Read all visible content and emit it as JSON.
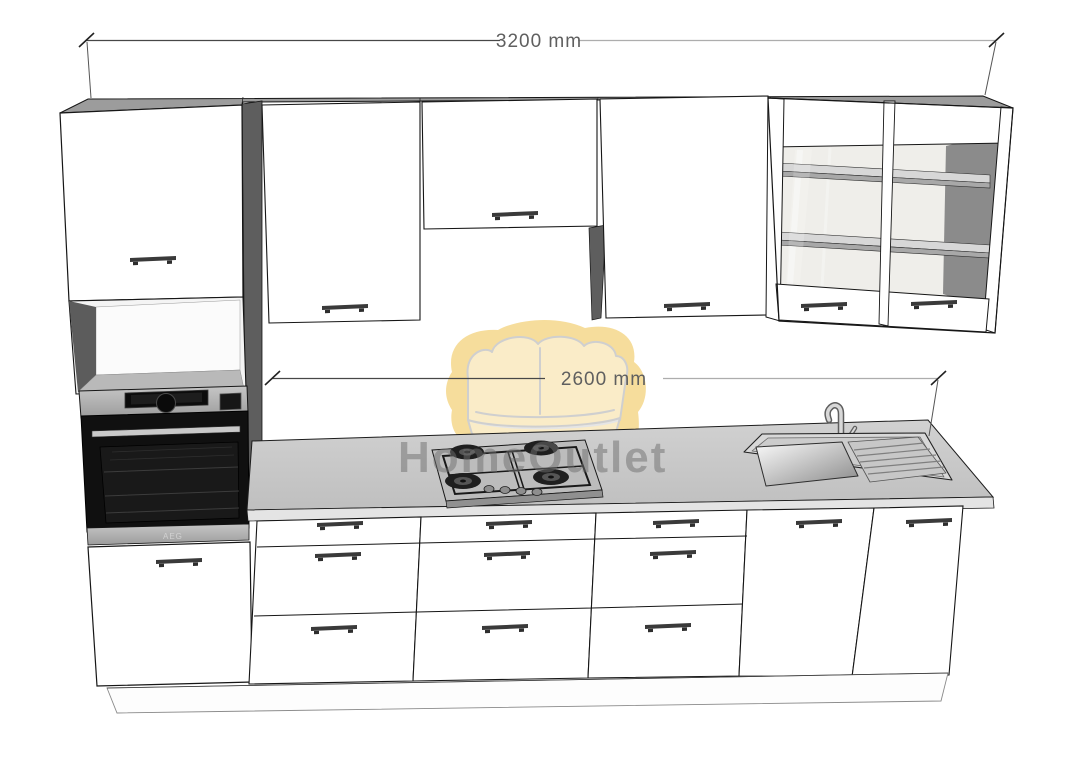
{
  "page": {
    "background": "#ffffff"
  },
  "annotations": {
    "total_width_label": "3200 mm",
    "worktop_width_label": "2600 mm"
  },
  "watermark": {
    "brand_text": "HomeOutlet",
    "icon": "sofa-icon",
    "icon_color": "#f6db97",
    "text_color": "#6f6f6f"
  },
  "appliances": {
    "oven_brand": "AEG"
  },
  "scene": {
    "wall_units": [
      "tall-unit-upper-door",
      "wall-cabinet",
      "short-wall-cabinet-over-hob",
      "wall-cabinet",
      "glass-display-cabinet-two-door"
    ],
    "base_units": [
      "tall-oven-housing",
      "three-drawer-base-unit",
      "three-drawer-base-unit",
      "three-drawer-base-unit",
      "sink-base-two-door"
    ],
    "appliances": [
      "built-in-oven",
      "gas-hob-four-burner",
      "inset-sink-with-drainer",
      "mixer-tap"
    ]
  },
  "colors": {
    "cabinet_front": "#ffffff",
    "cabinet_top": "#9c9c9c",
    "cabinet_side_shadow": "#5e5e5e",
    "worktop": "#c6c6c6",
    "handle": "#3a3a3a",
    "oven_body": "#111111",
    "stainless": "#b3b3b3",
    "dimension_line_dark": "#474747",
    "dimension_line_light": "#adadad",
    "dimension_text": "#5f5f5f",
    "watermark_yellow": "#f6db97"
  }
}
